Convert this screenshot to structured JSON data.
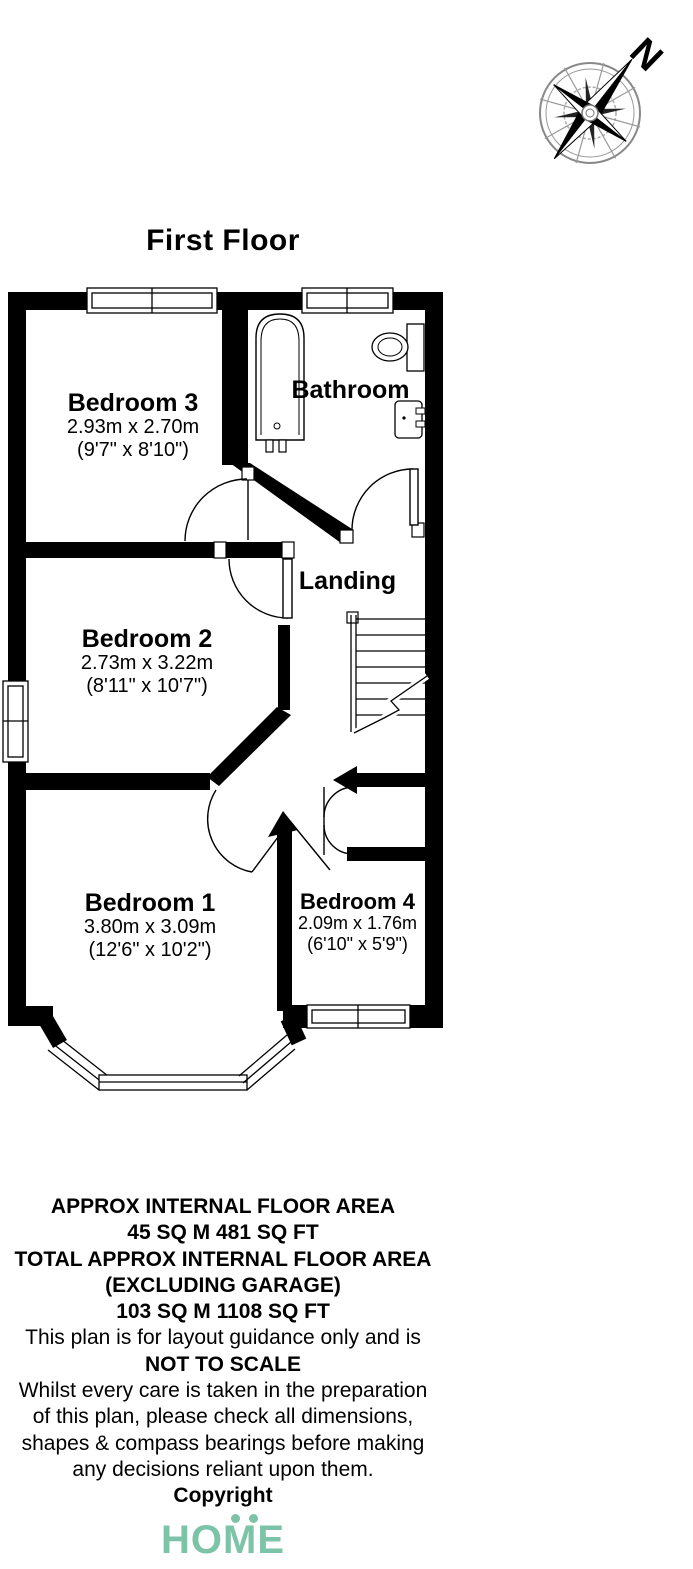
{
  "title": "First Floor",
  "compass": {
    "north_label": "N"
  },
  "rooms": {
    "bedroom3": {
      "name": "Bedroom 3",
      "dim_m": "2.93m x 2.70m",
      "dim_ft": "(9'7\" x 8'10\")"
    },
    "bathroom": {
      "name": "Bathroom"
    },
    "landing": {
      "name": "Landing"
    },
    "bedroom2": {
      "name": "Bedroom 2",
      "dim_m": "2.73m x 3.22m",
      "dim_ft": "(8'11\" x 10'7\")"
    },
    "bedroom1": {
      "name": "Bedroom 1",
      "dim_m": "3.80m x 3.09m",
      "dim_ft": "(12'6\" x 10'2\")"
    },
    "bedroom4": {
      "name": "Bedroom 4",
      "dim_m": "2.09m x 1.76m",
      "dim_ft": "(6'10\" x 5'9\")"
    }
  },
  "footer": {
    "lines": [
      {
        "text": "APPROX INTERNAL FLOOR AREA",
        "style": "bold"
      },
      {
        "text": "45 SQ M 481 SQ FT",
        "style": "bold"
      },
      {
        "text": "TOTAL APPROX INTERNAL FLOOR AREA",
        "style": "bold"
      },
      {
        "text": "(EXCLUDING GARAGE)",
        "style": "bold"
      },
      {
        "text": "103 SQ M 1108 SQ FT",
        "style": "bold"
      },
      {
        "text": "This plan is for layout guidance only and is",
        "style": "normal"
      },
      {
        "text": "NOT TO SCALE",
        "style": "bold"
      },
      {
        "text": "Whilst every care is taken in the preparation",
        "style": "normal"
      },
      {
        "text": "of this plan, please check all dimensions,",
        "style": "normal"
      },
      {
        "text": "shapes & compass bearings before making",
        "style": "normal"
      },
      {
        "text": "any decisions reliant upon them.",
        "style": "normal"
      },
      {
        "text": "Copyright",
        "style": "bold"
      }
    ],
    "logo_text": "HOME",
    "logo_color": "#7CC3A7"
  }
}
